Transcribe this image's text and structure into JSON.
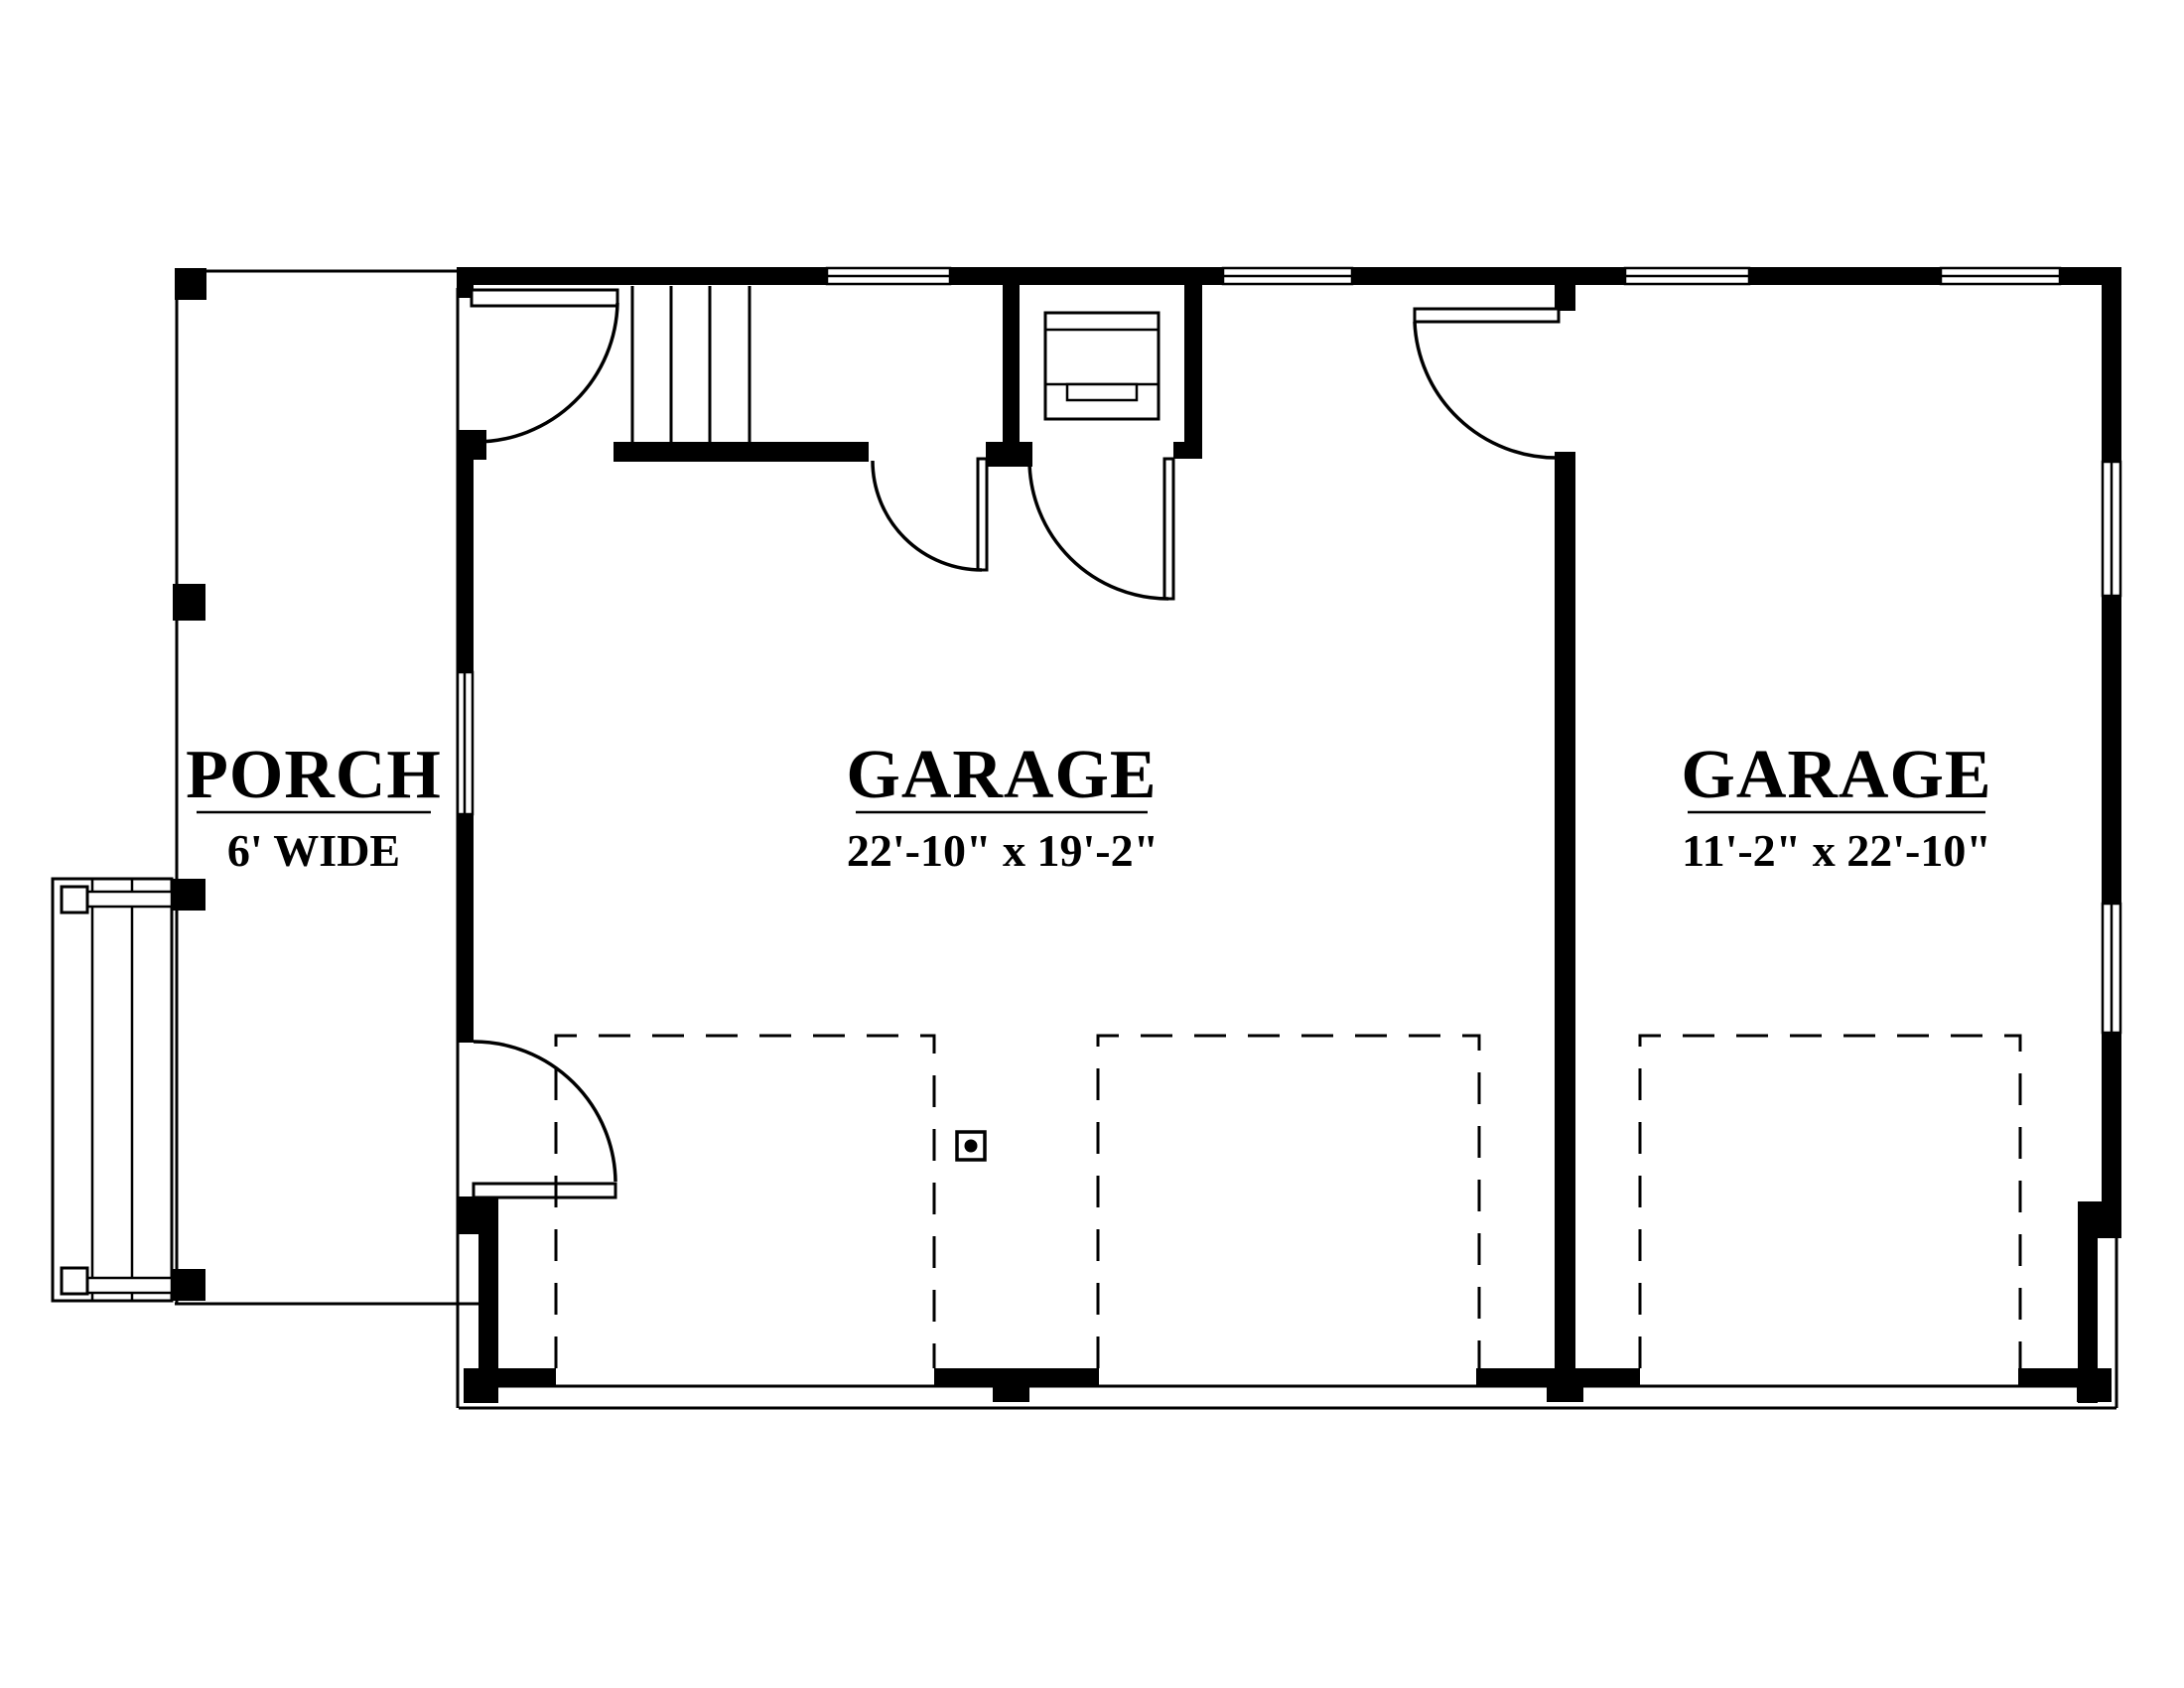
{
  "plan": {
    "rooms": [
      {
        "name": "PORCH",
        "dimensions": "6' WIDE"
      },
      {
        "name": "GARAGE",
        "dimensions": "22'-10\" x 19'-2\""
      },
      {
        "name": "GARAGE",
        "dimensions": "11'-2\" x 22'-10\""
      }
    ],
    "colors": {
      "wall": "#000000",
      "background": "#ffffff",
      "line": "#000000"
    }
  }
}
